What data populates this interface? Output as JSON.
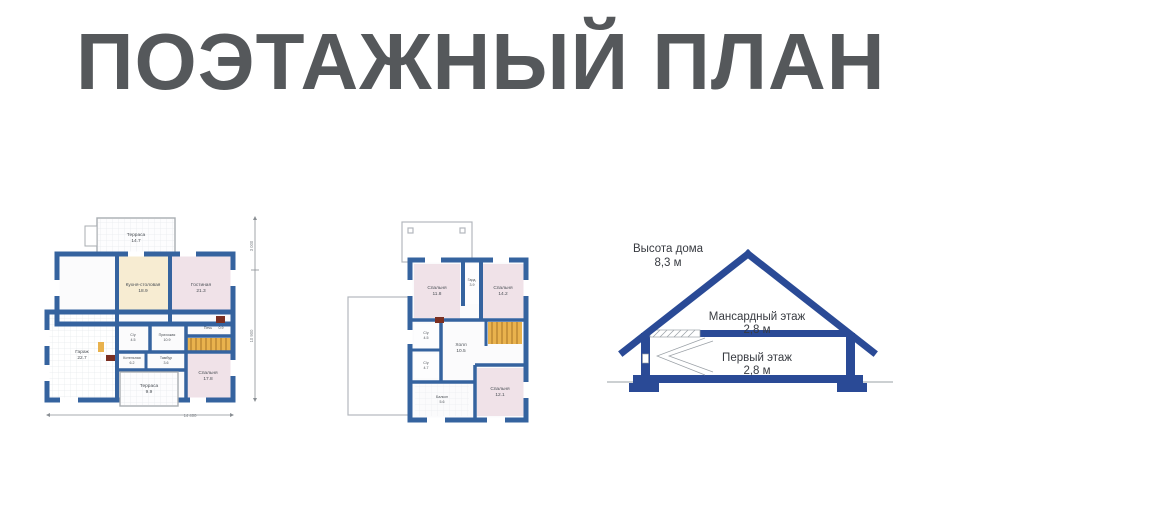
{
  "title": "ПОЭТАЖНЫЙ ПЛАН",
  "colors": {
    "title_text": "#55585b",
    "plan_wall_blue": "#35639f",
    "section_blue": "#2a4a96",
    "room_pink": "#f0e2e8",
    "room_cream": "#f7ecd2",
    "stairs_orange": "#e9b24d",
    "door_dark_red": "#7b2f21",
    "thin_outline_gray": "#b3b8bd"
  },
  "floor1": {
    "rooms": [
      {
        "name": "Терраса",
        "area": "14.7"
      },
      {
        "name": "Кухня-столовая",
        "area": "18.9"
      },
      {
        "name": "Гостиная",
        "area": "21.3"
      },
      {
        "name": "Гараж",
        "area": "22.7"
      },
      {
        "name": "С/у",
        "area": "4.5"
      },
      {
        "name": "Прихожая",
        "area": "10.9"
      },
      {
        "name": "Печь",
        "area": "0.9"
      },
      {
        "name": "Котельная",
        "area": "6.2"
      },
      {
        "name": "Тамбур",
        "area": "3.6"
      },
      {
        "name": "Спальня",
        "area": "17.8"
      },
      {
        "name": "Терраса",
        "area": "9.9"
      }
    ],
    "dims": {
      "bottom": "14 400",
      "side_top": "3 000",
      "side_main": "10 900"
    }
  },
  "floor2": {
    "rooms": [
      {
        "name": "Спальня",
        "area": "11.8"
      },
      {
        "name": "Гард.",
        "area": "3.9"
      },
      {
        "name": "Спальня",
        "area": "14.2"
      },
      {
        "name": "С/у",
        "area": "4.5"
      },
      {
        "name": "Холл",
        "area": "10.5"
      },
      {
        "name": "С/у",
        "area": "4.7"
      },
      {
        "name": "Балкон",
        "area": "5.6"
      },
      {
        "name": "Спальня",
        "area": "12.1"
      }
    ]
  },
  "section": {
    "height_title": "Высота дома",
    "height_value": "8,3 м",
    "mansard_title": "Мансардный этаж",
    "mansard_value": "2,8 м",
    "first_title": "Первый этаж",
    "first_value": "2,8 м"
  }
}
